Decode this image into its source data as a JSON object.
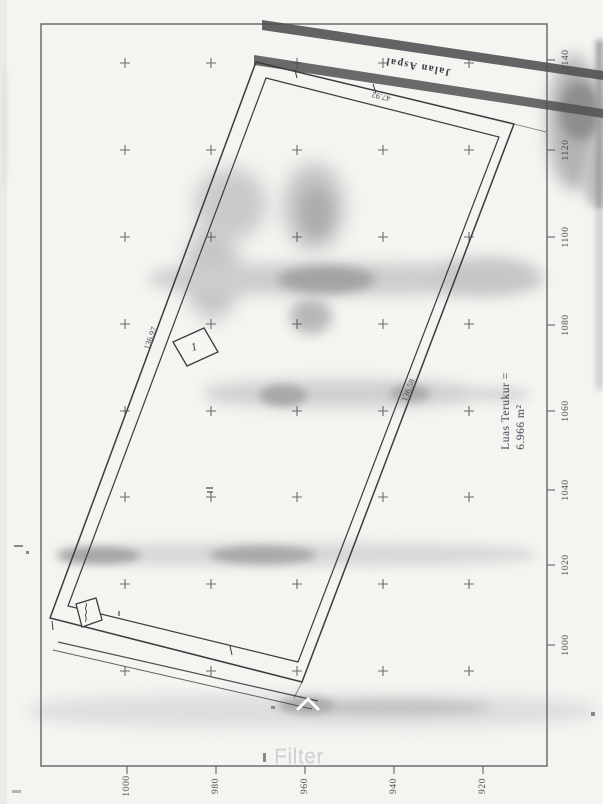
{
  "overlay": {
    "filter_label": "Filter",
    "chevron_icon": "chevron-up-icon"
  },
  "map": {
    "road_label": "Jalan Aspal",
    "area_label": {
      "line1": "Luas Terukur =",
      "line2": "6.966 m²"
    },
    "dimension_labels": {
      "left_edge": "136.97",
      "right_edge": "136.58",
      "top_edge": "47.92"
    },
    "structure_labels": {
      "box1": "1"
    },
    "grid": {
      "bottom_labels": [
        {
          "text": "1000",
          "x": 127
        },
        {
          "text": "980",
          "x": 216
        },
        {
          "text": "960",
          "x": 305
        },
        {
          "text": "940",
          "x": 394
        },
        {
          "text": "920",
          "x": 483
        }
      ],
      "right_labels": [
        {
          "text": "1140",
          "y": 60
        },
        {
          "text": "1120",
          "y": 150
        },
        {
          "text": "1100",
          "y": 237
        },
        {
          "text": "1080",
          "y": 325
        },
        {
          "text": "1060",
          "y": 411
        },
        {
          "text": "1040",
          "y": 490
        },
        {
          "text": "1020",
          "y": 565
        },
        {
          "text": "1000",
          "y": 645
        }
      ],
      "cross_columns": [
        125,
        211,
        297,
        383,
        469
      ],
      "cross_rows": [
        63,
        150,
        237,
        324,
        411,
        497,
        584,
        671
      ]
    }
  }
}
